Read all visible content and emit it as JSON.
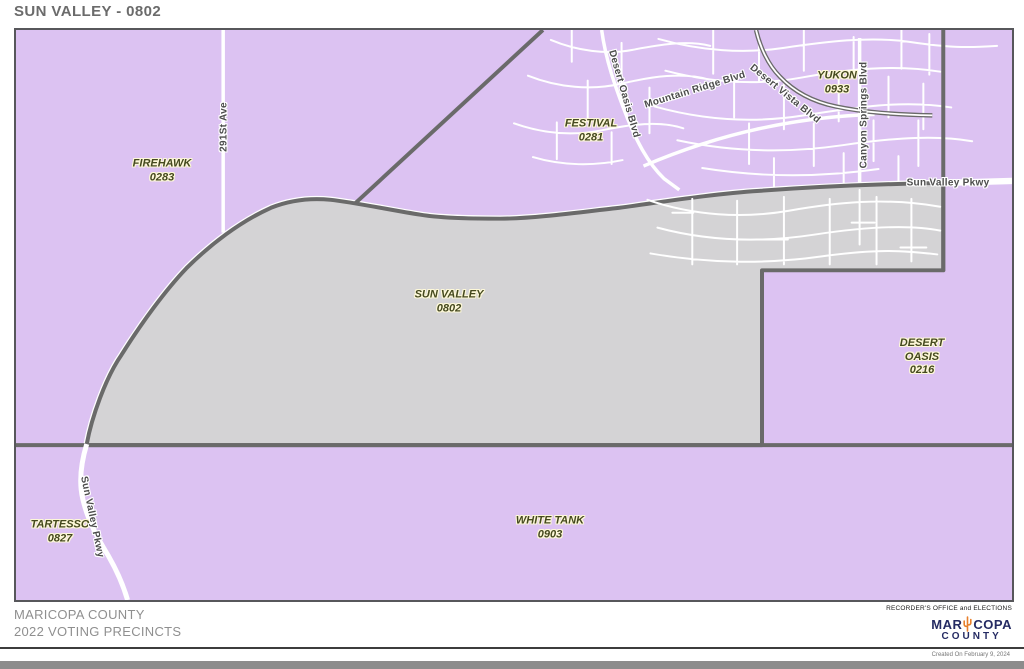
{
  "title": "SUN VALLEY - 0802",
  "colors": {
    "background": "#dcc2f2",
    "precinct_fill": "#d4d3d5",
    "boundary": "#6a6a6a",
    "road": "#ffffff",
    "precinct_label_text": "#45491f",
    "precinct_label_halo": "#fdf8d8",
    "road_label_text": "#4c4c4c",
    "logo_navy": "#252b63",
    "logo_orange": "#e8802d"
  },
  "precincts": [
    {
      "lines": [
        "FIREHAWK",
        "0283"
      ]
    },
    {
      "lines": [
        "FESTIVAL",
        "0281"
      ]
    },
    {
      "lines": [
        "YUKON",
        "0933"
      ]
    },
    {
      "lines": [
        "SUN VALLEY",
        "0802"
      ]
    },
    {
      "lines": [
        "DESERT",
        "OASIS",
        "0216"
      ]
    },
    {
      "lines": [
        "TARTESSO",
        "0827"
      ]
    },
    {
      "lines": [
        "WHITE TANK",
        "0903"
      ]
    }
  ],
  "roads": [
    {
      "label": "291St Ave"
    },
    {
      "label": "Desert Oasis Blvd"
    },
    {
      "label": "Mountain Ridge Blvd"
    },
    {
      "label": "Desert Vista Blvd"
    },
    {
      "label": "Canyon Springs Blvd"
    },
    {
      "label": "Sun Valley Pkwy"
    },
    {
      "label": "Sun Valley Pkwy"
    }
  ],
  "footer": {
    "county": "MARICOPA COUNTY",
    "subtitle": "2022 VOTING PRECINCTS",
    "office": "RECORDER'S OFFICE and ELECTIONS",
    "logo_left": "MAR",
    "logo_right": "COPA",
    "logo_bottom": "COUNTY",
    "created": "Created On February 9, 2024"
  }
}
